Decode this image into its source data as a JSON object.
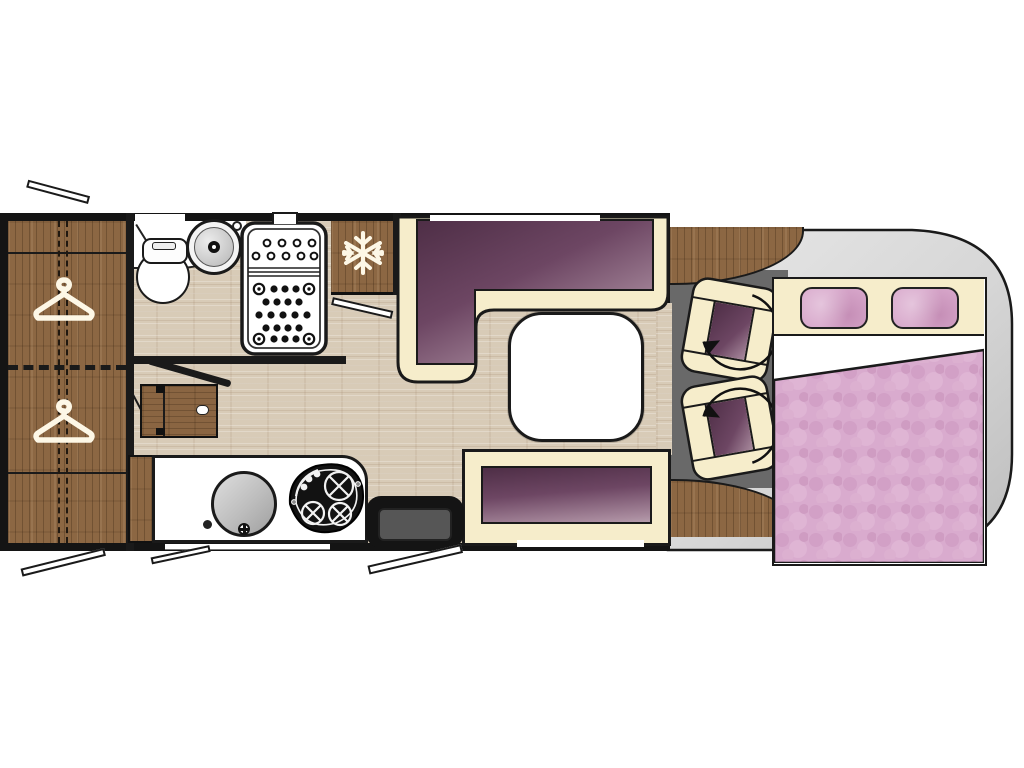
{
  "diagram": {
    "title": "Motorhome floor plan (top view)",
    "type": "floorplan",
    "text_labels": [],
    "palette": {
      "wall_black": "#141414",
      "wood_brown": "#8c6743",
      "floor_beige": "#d8cbb7",
      "upholstery_purple_dark": "#4e2e46",
      "upholstery_purple_light": "#b59dac",
      "trim_cream": "#f6edcb",
      "cab_floor_gray": "#696969",
      "vehicle_body_gray": "#d9d9d9",
      "bedding_pink": "#d9abce",
      "fixture_white": "#ffffff"
    },
    "zones": {
      "rear_wardrobe": {
        "label": "Wardrobe",
        "icon": "hanger-icon",
        "hanger_count": 2
      },
      "bathroom": {
        "label": "Bathroom",
        "items": [
          "toilet",
          "washbasin",
          "shower tray"
        ]
      },
      "galley": {
        "label": "Kitchen",
        "items": [
          "worktop",
          "round sink",
          "hob with 3 burners",
          "fold-down table",
          "refrigerator"
        ]
      },
      "refrigerator": {
        "label": "Refrigerator",
        "icon": "snowflake-icon"
      },
      "dinette": {
        "label": "Dinette",
        "items": [
          "L-shaped sofa",
          "square table",
          "side bench"
        ]
      },
      "entrance": {
        "label": "Entrance",
        "items": [
          "entry step",
          "entry door (open)"
        ]
      },
      "cab": {
        "label": "Driver cab",
        "items": [
          "swivel seat x2"
        ],
        "icon": "rotation-arrow-icon",
        "seat_count": 2
      },
      "front_bed": {
        "label": "Drop-down double bed",
        "items": [
          "headboard shelf",
          "pillow x2",
          "duvet"
        ],
        "pillow_count": 2
      }
    },
    "openings": {
      "top_wall_windows": 2,
      "bottom_wall_windows": 2,
      "open_window_flaps": 3,
      "entry_door_flap": 1,
      "interior_doors": [
        "bathroom door (open leaf)",
        "wardrobe door swing"
      ]
    }
  }
}
